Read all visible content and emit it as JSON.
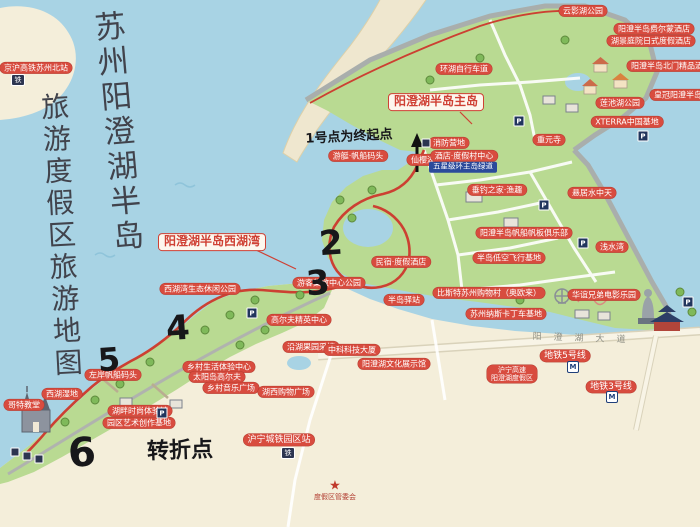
{
  "title": {
    "line1": "苏州阳澄湖半岛",
    "line2": "旅游度假区旅游地图"
  },
  "map": {
    "accent_colors": {
      "label_red": "#d84c3f",
      "route_red": "#cc4032",
      "water": "#a8d3e4",
      "land_green": "#b9da92",
      "sand": "#f4eeda",
      "navy": "#2b4a9b"
    },
    "labels": [
      {
        "t": "京沪高铁苏州北站",
        "x": 36,
        "y": 68,
        "type": "pill",
        "n": "label-gaotie-north-station"
      },
      {
        "t": "云影湖公园",
        "x": 583,
        "y": 11,
        "type": "pill",
        "n": "label-yunying-lake-park"
      },
      {
        "t": "阳澄半岛费尔蒙酒店",
        "x": 654,
        "y": 29,
        "type": "pill",
        "n": "label-hotel-1"
      },
      {
        "t": "湖景庭院日式度假酒店",
        "x": 651,
        "y": 41,
        "type": "pill",
        "n": "label-hotel-2"
      },
      {
        "t": "环湖自行车道",
        "x": 464,
        "y": 69,
        "type": "pill",
        "n": "label-lakeside-bike-path"
      },
      {
        "t": "阳澄半岛北门精品酒店",
        "x": 671,
        "y": 66,
        "type": "pill",
        "n": "label-hotel-3"
      },
      {
        "t": "皇冠阳澄半岛酒店",
        "x": 686,
        "y": 95,
        "type": "pill",
        "n": "label-hotel-4"
      },
      {
        "t": "莲池湖公园",
        "x": 620,
        "y": 103,
        "type": "pill",
        "n": "label-lianchi-lake-park"
      },
      {
        "t": "XTERRA中国基地",
        "x": 627,
        "y": 122,
        "type": "pill",
        "n": "label-xterra-china-base"
      },
      {
        "t": "重元寺",
        "x": 549,
        "y": 140,
        "type": "pill",
        "n": "label-chongyuan-temple"
      },
      {
        "t": "消防营地",
        "x": 449,
        "y": 143,
        "type": "pill",
        "n": "label-fire-camp"
      },
      {
        "t": "仙樱湖公园",
        "x": 431,
        "y": 160,
        "type": "pill",
        "n": "label-xianying-lake-park"
      },
      {
        "t": "游艇·帆船码头",
        "x": 358,
        "y": 156,
        "type": "pill",
        "n": "label-yacht-marina"
      },
      {
        "t": "酒店·度假村中心",
        "x": 464,
        "y": 156,
        "type": "pill",
        "n": "label-resort-center"
      },
      {
        "t": "五星级环主岛绿道",
        "x": 463,
        "y": 167,
        "type": "navy",
        "n": "label-greenway"
      },
      {
        "t": "垂钓之家·渔趣",
        "x": 497,
        "y": 190,
        "type": "pill",
        "n": "label-fishing-home"
      },
      {
        "t": "悬居水中天",
        "x": 592,
        "y": 193,
        "type": "pill",
        "n": "label-water-villas"
      },
      {
        "t": "阳澄半岛帆船帆板俱乐部",
        "x": 524,
        "y": 233,
        "type": "pill",
        "n": "label-sailing-club"
      },
      {
        "t": "浅水湾",
        "x": 612,
        "y": 247,
        "type": "pill",
        "n": "label-shallow-bay"
      },
      {
        "t": "半岛低空飞行基地",
        "x": 509,
        "y": 258,
        "type": "pill",
        "n": "label-flight-base"
      },
      {
        "t": "比斯特苏州购物村（奥欧来）",
        "x": 489,
        "y": 293,
        "type": "pill",
        "n": "label-shopping-village"
      },
      {
        "t": "华谊兄弟电影乐园",
        "x": 604,
        "y": 295,
        "type": "pill",
        "n": "label-huayi-movie-park"
      },
      {
        "t": "苏州纳斯卡丁车基地",
        "x": 506,
        "y": 314,
        "type": "pill",
        "n": "label-karting-base"
      },
      {
        "t": "阳澄湖半岛主岛",
        "x": 436,
        "y": 102,
        "type": "box",
        "n": "label-main-island"
      },
      {
        "t": "阳澄湖半岛西湖湾",
        "x": 212,
        "y": 242,
        "type": "box",
        "n": "label-west-lake-bay"
      },
      {
        "t": "西湖湾生态休闲公园",
        "x": 200,
        "y": 289,
        "type": "pill",
        "n": "label-westbay-eco-park"
      },
      {
        "t": "游客集散中心公园",
        "x": 329,
        "y": 283,
        "type": "pill",
        "n": "label-visitor-center-park"
      },
      {
        "t": "民宿·度假酒店",
        "x": 401,
        "y": 262,
        "type": "pill",
        "n": "label-homestay-hotels"
      },
      {
        "t": "半岛驿站",
        "x": 404,
        "y": 300,
        "type": "pill",
        "n": "label-peninsula-stop"
      },
      {
        "t": "高尔夫精英中心",
        "x": 299,
        "y": 320,
        "type": "pill",
        "n": "label-golf-elite-center"
      },
      {
        "t": "沿湖果园采摘",
        "x": 311,
        "y": 347,
        "type": "pill",
        "n": "label-orchard-picking"
      },
      {
        "t": "中科科技大厦",
        "x": 352,
        "y": 350,
        "type": "pill",
        "n": "label-tech-tower"
      },
      {
        "t": "阳澄湖文化展示馆",
        "x": 394,
        "y": 364,
        "type": "pill",
        "n": "label-culture-hall"
      },
      {
        "t": "乡村生活体验中心",
        "x": 219,
        "y": 367,
        "type": "pill",
        "n": "label-country-life-center"
      },
      {
        "t": "太阳岛高尔夫",
        "x": 217,
        "y": 377,
        "type": "pill",
        "n": "label-sun-island-golf"
      },
      {
        "t": "乡村音乐广场",
        "x": 231,
        "y": 388,
        "type": "pill",
        "n": "label-music-plaza"
      },
      {
        "t": "湖西购物广场",
        "x": 286,
        "y": 392,
        "type": "pill",
        "n": "label-west-shopping-plaza"
      },
      {
        "t": "左岸帆船码头",
        "x": 113,
        "y": 375,
        "type": "pill",
        "n": "label-left-bank-marina"
      },
      {
        "t": "西湖湿地",
        "x": 62,
        "y": 394,
        "type": "pill",
        "n": "label-west-lake-wetland"
      },
      {
        "t": "哥特教堂",
        "x": 24,
        "y": 405,
        "type": "pill",
        "n": "label-gothic-church"
      },
      {
        "t": "湖畔时尚体验馆",
        "x": 140,
        "y": 411,
        "type": "pill",
        "n": "label-fashion-hall"
      },
      {
        "t": "园区艺术创作基地",
        "x": 139,
        "y": 423,
        "type": "pill",
        "n": "label-art-base"
      },
      {
        "t": "沪宁城铁园区站",
        "x": 279,
        "y": 440,
        "type": "pill",
        "s": 9,
        "n": "label-intercity-rail-station"
      },
      {
        "t": "地铁5号线",
        "x": 565,
        "y": 356,
        "type": "pill",
        "s": 9,
        "n": "label-metro-line-5"
      },
      {
        "t": "沪宁高速\n阳澄湖度假区",
        "x": 512,
        "y": 374,
        "type": "pill2",
        "n": "label-huning-expressway"
      },
      {
        "t": "地铁3号线",
        "x": 611,
        "y": 387,
        "type": "pill",
        "s": 9,
        "n": "label-metro-line-3"
      },
      {
        "t": "1号点为终起点",
        "x": 349,
        "y": 138,
        "type": "hand",
        "s": 13,
        "r": -3,
        "n": "note-point1-start-end"
      },
      {
        "t": "2",
        "x": 331,
        "y": 244,
        "type": "hand",
        "s": 34,
        "n": "route-number-2"
      },
      {
        "t": "3",
        "x": 318,
        "y": 284,
        "type": "hand",
        "s": 34,
        "n": "route-number-3"
      },
      {
        "t": "4",
        "x": 178,
        "y": 329,
        "type": "hand",
        "s": 34,
        "n": "route-number-4"
      },
      {
        "t": "5",
        "x": 109,
        "y": 360,
        "type": "hand",
        "s": 32,
        "n": "route-number-5"
      },
      {
        "t": "6",
        "x": 82,
        "y": 453,
        "type": "hand",
        "s": 40,
        "n": "route-number-6"
      },
      {
        "t": "转折点",
        "x": 180,
        "y": 451,
        "type": "hand",
        "s": 22,
        "r": -2,
        "n": "note-turning-point"
      },
      {
        "t": "阳澄湖大道",
        "x": 585,
        "y": 339,
        "type": "road",
        "r": 2,
        "ls": 12,
        "n": "road-name-yangchenghu-ave"
      },
      {
        "t": "度假区管委会",
        "x": 335,
        "y": 497,
        "type": "note",
        "n": "note-resort-committee"
      }
    ],
    "icons": [
      {
        "name": "parking-icon",
        "glyph": "P",
        "cls": "icon-p",
        "x": 519,
        "y": 121
      },
      {
        "name": "parking-icon",
        "glyph": "P",
        "cls": "icon-p",
        "x": 643,
        "y": 136
      },
      {
        "name": "parking-icon",
        "glyph": "P",
        "cls": "icon-p",
        "x": 583,
        "y": 243
      },
      {
        "name": "parking-icon",
        "glyph": "P",
        "cls": "icon-p",
        "x": 688,
        "y": 302
      },
      {
        "name": "parking-icon",
        "glyph": "P",
        "cls": "icon-p",
        "x": 252,
        "y": 313
      },
      {
        "name": "parking-icon",
        "glyph": "P",
        "cls": "icon-p",
        "x": 162,
        "y": 413
      },
      {
        "name": "parking-icon",
        "glyph": "P",
        "cls": "icon-p",
        "x": 544,
        "y": 205
      },
      {
        "name": "metro-icon",
        "glyph": "M",
        "cls": "icon-m",
        "x": 573,
        "y": 367
      },
      {
        "name": "metro-icon",
        "glyph": "M",
        "cls": "icon-m",
        "x": 612,
        "y": 397
      },
      {
        "name": "train-icon",
        "glyph": "铁",
        "cls": "icon-train",
        "x": 288,
        "y": 453
      },
      {
        "name": "train-icon",
        "glyph": "铁",
        "cls": "icon-train",
        "x": 18,
        "y": 80
      },
      {
        "name": "poi-icon",
        "glyph": "",
        "cls": "icon-misc",
        "x": 15,
        "y": 452
      },
      {
        "name": "poi-icon",
        "glyph": "",
        "cls": "icon-misc",
        "x": 27,
        "y": 456
      },
      {
        "name": "poi-icon",
        "glyph": "",
        "cls": "icon-misc",
        "x": 39,
        "y": 459
      },
      {
        "name": "poi-icon",
        "glyph": "",
        "cls": "icon-misc",
        "x": 426,
        "y": 143
      },
      {
        "name": "star-icon",
        "glyph": "★",
        "cls": "icon-star",
        "x": 335,
        "y": 486
      }
    ]
  }
}
